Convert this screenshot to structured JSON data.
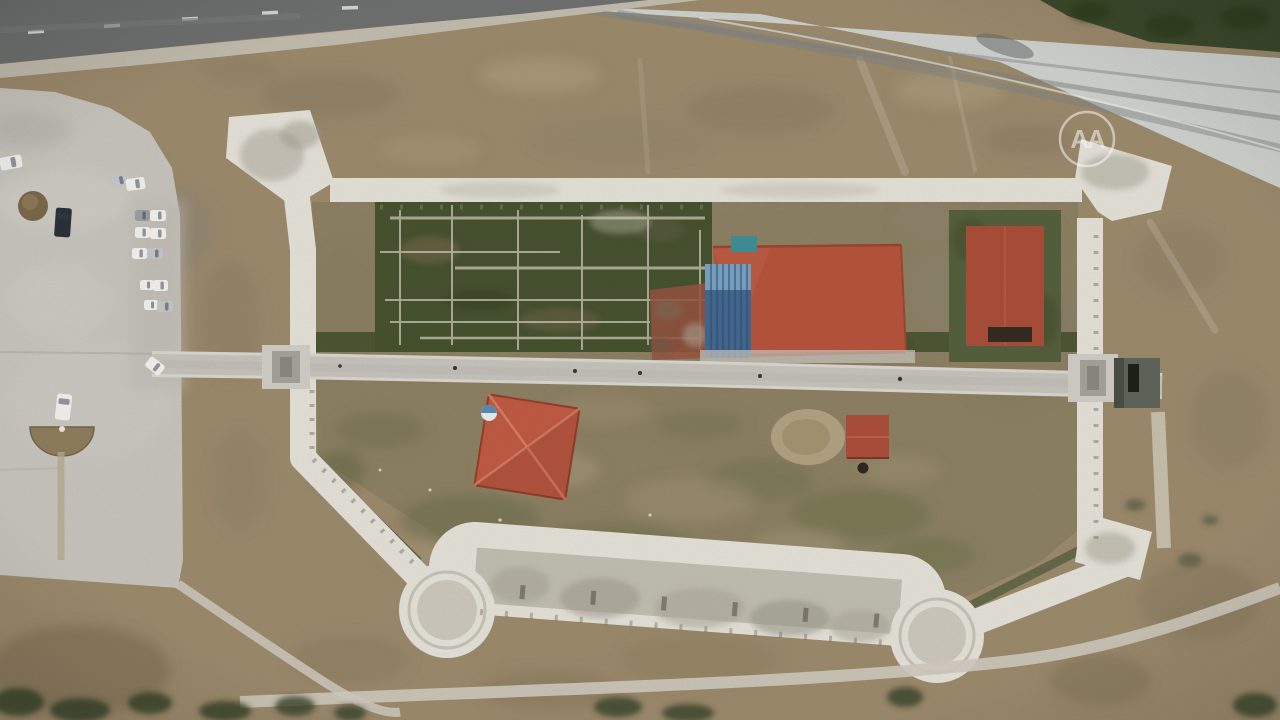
{
  "scene": {
    "watermark": {
      "text": "AA"
    },
    "colors": {
      "ground": "#9c8a6c",
      "ground_inner": "#8d8063",
      "wall_light": "#e4e1d8",
      "wall_walkway": "#b5b1a4",
      "asphalt_road": "#6f7170",
      "road_shoulder": "#c2bcae",
      "concrete_road": "#ced1cd",
      "trees_dark": "#3c4a2c",
      "parking_lot": "#c7c4bd",
      "causeway": "#c6c3bc",
      "causeway_edge": "#d9d6cf",
      "gate_grey": "#d0cdc6",
      "gate_inner": "#a5a29a",
      "dark_structure": "#5f655a",
      "excavation_green": "#46522f",
      "grass_green": "#55603e",
      "moat_green": "#4e5a39",
      "ruin_line": "#cfc8b8",
      "museum_roof": "#b5543c",
      "glass_blue": "#44688f",
      "glass_blue_light": "#7fa9c4",
      "teal_roof": "#3f8e96",
      "east_roof": "#a84e38",
      "east_door_dark": "#352b22",
      "sw_roof": "#bf5a42",
      "small_roof": "#ab4f3a",
      "brick_ruin": "#96543f",
      "excavation_ring": "#bfae8e",
      "dirt_mound": "#8b7a58",
      "path_light": "#cfcabf",
      "car_white": "#f1f0ec",
      "car_silver": "#c3c7c9",
      "car_grey": "#9aa0a2",
      "car_dark": "#2b3138"
    },
    "cars": [
      {
        "x": 0,
        "y": 156,
        "w": 22,
        "h": 13,
        "r": -10,
        "c": "white"
      },
      {
        "x": 111,
        "y": 175,
        "w": 17,
        "h": 11,
        "r": -12,
        "c": "silver"
      },
      {
        "x": 126,
        "y": 178,
        "w": 19,
        "h": 12,
        "r": -8,
        "c": "white"
      },
      {
        "x": 55,
        "y": 208,
        "w": 16,
        "h": 29,
        "r": 4,
        "c": "dark"
      },
      {
        "x": 135,
        "y": 210,
        "w": 15,
        "h": 11,
        "r": 0,
        "c": "grey"
      },
      {
        "x": 150,
        "y": 210,
        "w": 16,
        "h": 11,
        "r": 0,
        "c": "white"
      },
      {
        "x": 135,
        "y": 227,
        "w": 15,
        "h": 11,
        "r": 0,
        "c": "white"
      },
      {
        "x": 150,
        "y": 228,
        "w": 16,
        "h": 11,
        "r": 0,
        "c": "white"
      },
      {
        "x": 132,
        "y": 248,
        "w": 15,
        "h": 11,
        "r": 0,
        "c": "white"
      },
      {
        "x": 147,
        "y": 248,
        "w": 16,
        "h": 11,
        "r": 0,
        "c": "silver"
      },
      {
        "x": 140,
        "y": 280,
        "w": 14,
        "h": 10,
        "r": 0,
        "c": "white"
      },
      {
        "x": 153,
        "y": 280,
        "w": 15,
        "h": 11,
        "r": 0,
        "c": "white"
      },
      {
        "x": 144,
        "y": 300,
        "w": 14,
        "h": 10,
        "r": 0,
        "c": "white"
      },
      {
        "x": 157,
        "y": 301,
        "w": 16,
        "h": 11,
        "r": 0,
        "c": "silver"
      },
      {
        "x": 146,
        "y": 360,
        "w": 18,
        "h": 12,
        "r": 38,
        "c": "white"
      },
      {
        "x": 56,
        "y": 394,
        "w": 15,
        "h": 26,
        "r": 6,
        "c": "white"
      }
    ]
  }
}
